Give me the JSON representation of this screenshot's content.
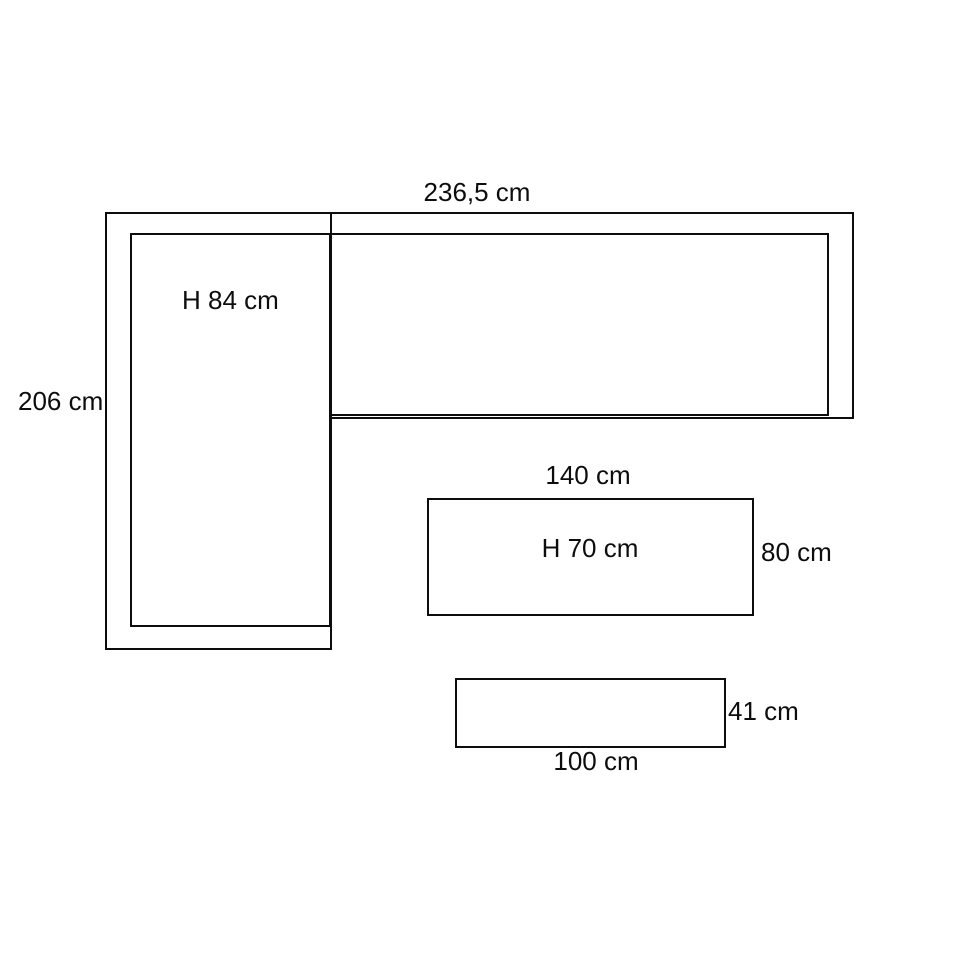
{
  "canvas": {
    "background": "#ffffff",
    "line_color": "#0d0d0d",
    "text_color": "#0d0d0d"
  },
  "pieces": {
    "corner_sofa": {
      "width_label": "236,5 cm",
      "depth_label": "206 cm",
      "height_label": "H 84 cm"
    },
    "bench": {
      "width_label": "140 cm",
      "height_label": "H 70 cm",
      "depth_label": "80 cm"
    },
    "ottoman": {
      "width_label": "100 cm",
      "depth_label": "41 cm"
    }
  }
}
